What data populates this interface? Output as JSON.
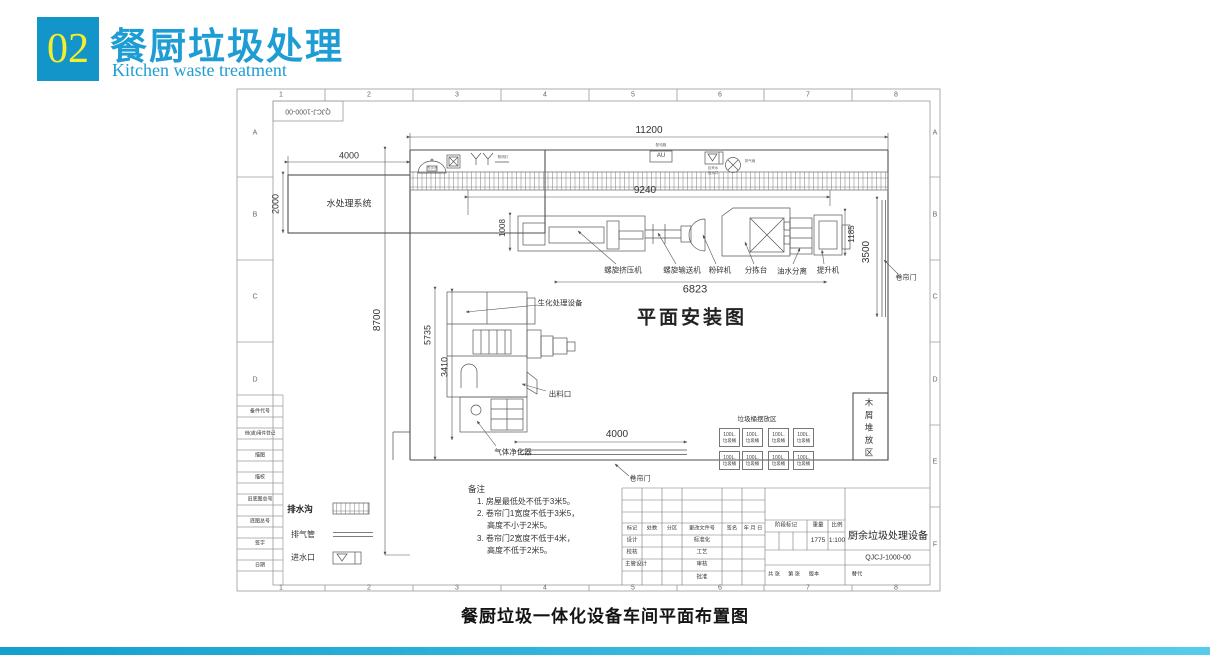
{
  "header": {
    "number": "02",
    "title": "餐厨垃圾处理",
    "subtitle": "Kitchen waste treatment"
  },
  "caption": "餐厨垃圾一体化设备车间平面布置图",
  "colors": {
    "accent_blue": "#1495ca",
    "title_blue": "#1e9cd4",
    "number_yellow": "#f6ee2d",
    "line": "#555555"
  },
  "frame": {
    "cols": [
      "1",
      "2",
      "3",
      "4",
      "5",
      "6",
      "7",
      "8"
    ],
    "rows": [
      "A",
      "B",
      "C",
      "D",
      "E",
      "F"
    ],
    "stamp": "QJCJ-1000-00"
  },
  "side_strip": {
    "rows": [
      "备件代号",
      "借(通)用件登记",
      "描图",
      "描校",
      "旧底图总号",
      "底图总号",
      "签字",
      "日期"
    ]
  },
  "plan": {
    "title": "平面安装图",
    "water_room": "水处理系统",
    "bio_label": "生化处理设备",
    "outlet_label": "出料口",
    "gas_label": "气体净化器",
    "bins_area_label": "垃圾桶摆放区",
    "wood_area_label": "木屑堆放区",
    "door_label_right": "卷帘门",
    "door_label_bottom": "卷帘门",
    "equipment": [
      "螺旋挤压机",
      "螺旋输送机",
      "粉碎机",
      "分拣台",
      "油水分离",
      "提升机"
    ],
    "bin": {
      "size": "100L.",
      "name": "垃圾桶"
    },
    "tiny": {
      "basin": "洗手池",
      "lamp": "照明灯",
      "au": "AU",
      "dist_box": "配电箱",
      "inlet_1": "自来水",
      "inlet_2": "进水口",
      "fan": "排气扇"
    }
  },
  "dims": {
    "top": "11200",
    "inner_top": "9240",
    "water_w": "4000",
    "water_h": "2000",
    "left_total": "8700",
    "left_mid": "5735",
    "left_bio": "3410",
    "equip_left": "1008",
    "equip_bottom": "6823",
    "equip_right": "1185",
    "door_right": "3500",
    "door_bottom": "4000"
  },
  "legend": {
    "drain": "排水沟",
    "vent": "排气管",
    "inlet": "进水口"
  },
  "notes": {
    "title": "备注",
    "lines": [
      "1. 房屋最低处不低于3米5。",
      "2. 卷帘门1宽度不低于3米5，",
      "高度不小于2米5。",
      "3. 卷帘门2宽度不低于4米，",
      "高度不低于2米5。"
    ]
  },
  "title_block": {
    "rev_cols": [
      "标记",
      "处数",
      "分区",
      "更改文件号",
      "签名",
      "年 月 日"
    ],
    "left_col": [
      "设计",
      "校核",
      "主管设计"
    ],
    "mid_col": [
      "标准化",
      "工艺",
      "审核",
      "批准"
    ],
    "stage": "阶段标记",
    "weight_label": "重量",
    "weight": "1775",
    "scale_label": "比例",
    "scale": "1:100",
    "product": "厨余垃圾处理设备",
    "code": "QJCJ-1000-00",
    "sheets": "共 张",
    "page": "第 张",
    "version": "版本",
    "replace": "替代"
  }
}
